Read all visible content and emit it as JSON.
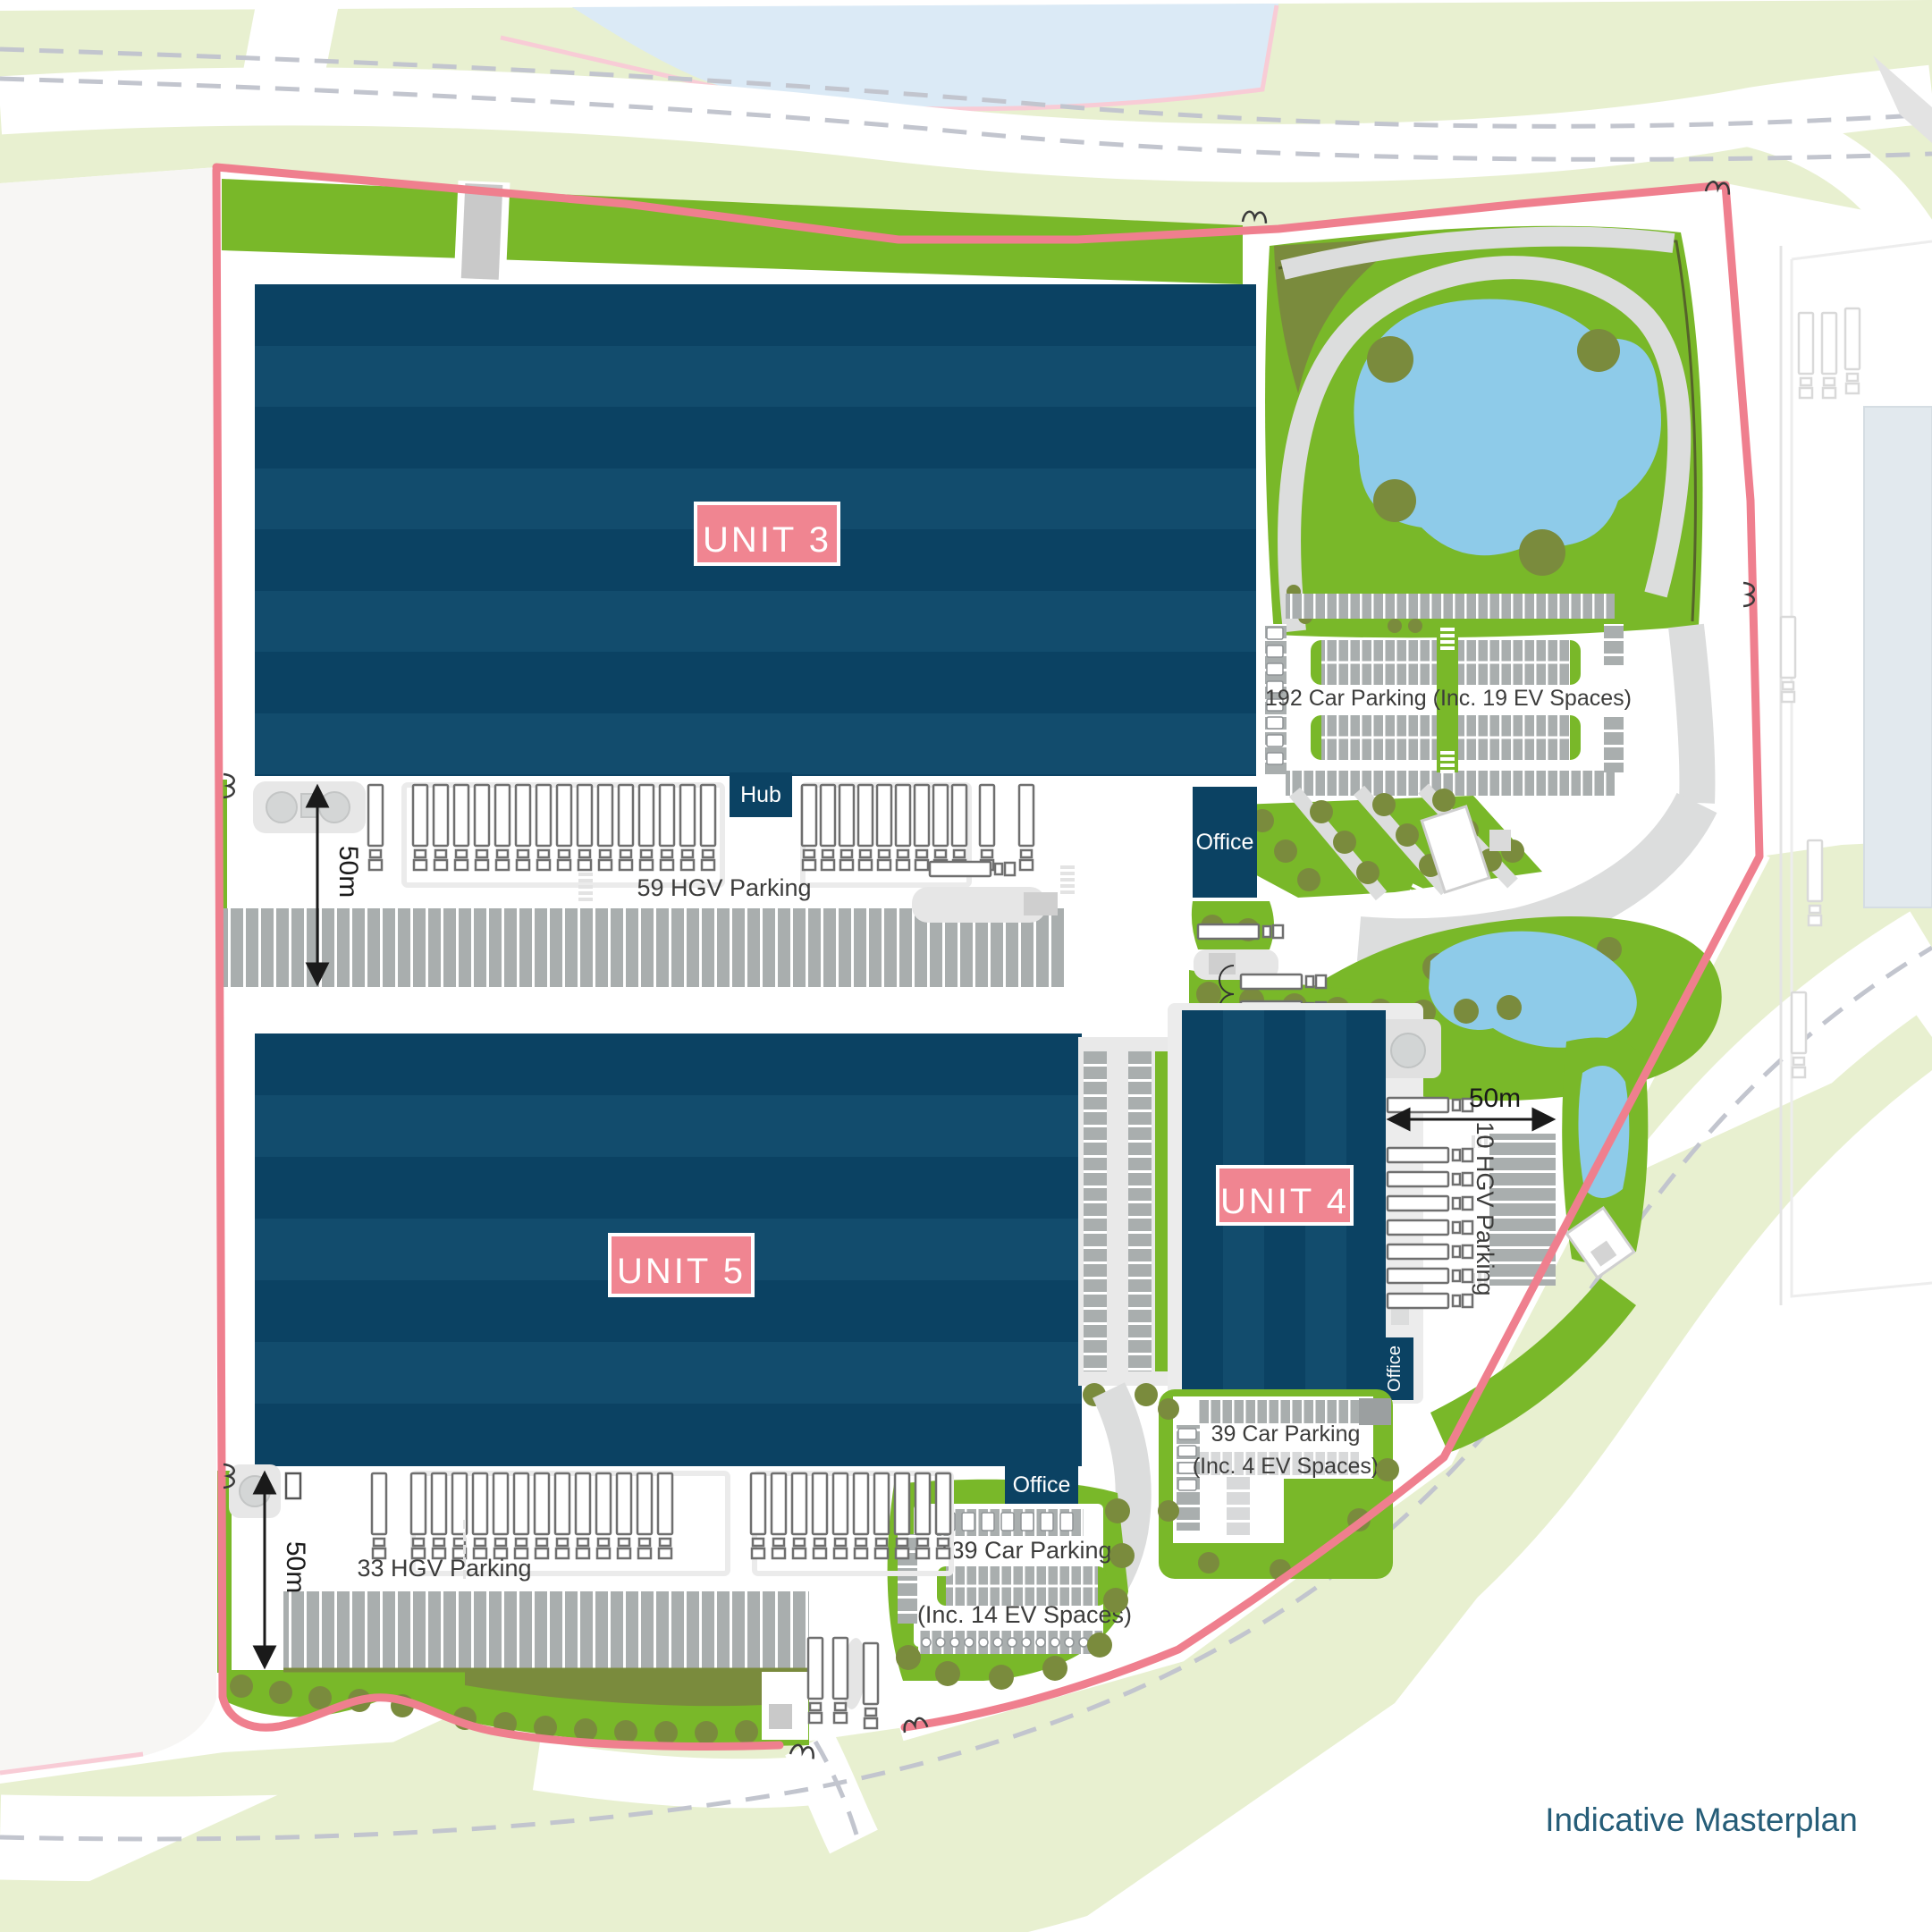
{
  "page": {
    "type": "site-masterplan",
    "caption": "Indicative Masterplan"
  },
  "units": {
    "unit3": "UNIT 3",
    "unit4": "UNIT 4",
    "unit5": "UNIT 5"
  },
  "buildings": {
    "hub_label": "Hub",
    "office_label": "Office"
  },
  "parking": {
    "hgv_59": "59 HGV Parking",
    "hgv_33": "33 HGV Parking",
    "hgv_10": "10 HGV Parking",
    "car_192": "192 Car Parking (Inc. 19 EV Spaces)",
    "car_139_line1": "139 Car Parking",
    "car_139_line2": "(Inc. 14 EV Spaces)",
    "car_39_line1": "39 Car Parking",
    "car_39_line2": "(Inc. 4 EV Spaces)"
  },
  "dimensions": {
    "yard_depth": "50m"
  },
  "colors": {
    "navy": "#0b4263",
    "navy2": "#124c6d",
    "label_pink": "#f08591",
    "boundary": "#ef7f8e",
    "green": "#79b829",
    "olive": "#7a8b3d",
    "pale_green": "#e8f0d0",
    "pond": "#8ecbe9",
    "water": "#dbeaf6",
    "stall_gray": "#a9aeae",
    "stall_light": "#d8d9da",
    "path_gray": "#dcdddd",
    "field": "#f7f6f4",
    "dash_gray": "#c2c5ce",
    "text_dark": "#3c3c3b",
    "caption_teal": "#265d78"
  }
}
